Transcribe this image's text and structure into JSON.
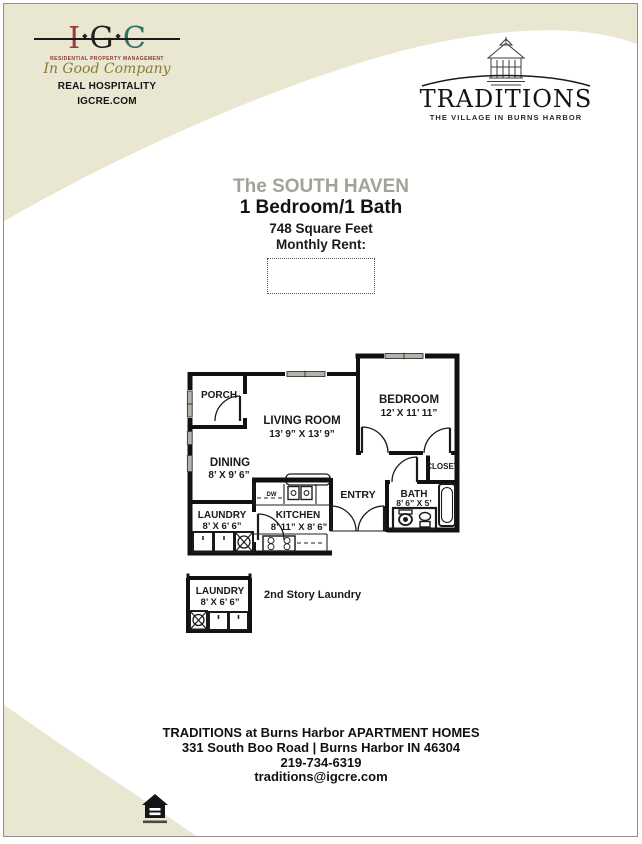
{
  "colors": {
    "beige": "#e9e6d2",
    "border_gray": "#8f8f8f",
    "title_gray": "#a2a296",
    "igc_i": "#9e3a31",
    "igc_g": "#23201d",
    "igc_c": "#2f6f66",
    "igc_script_olive": "#8d7b35",
    "igc_subtitle_maroon": "#8a3a33"
  },
  "header": {
    "igc": {
      "letters": [
        "I",
        "G",
        "C"
      ],
      "separator": "◆",
      "subtitle": "RESIDENTIAL PROPERTY MANAGEMENT",
      "script": "In Good Company",
      "line1": "REAL HOSPITALITY",
      "line2": "IGCRE.COM"
    },
    "traditions": {
      "wordmark": "TRADITIONS",
      "tagline": "THE VILLAGE IN BURNS HARBOR"
    }
  },
  "title": {
    "plan_name": "The SOUTH HAVEN",
    "config": "1 Bedroom/1 Bath",
    "sqft": "748 Square Feet",
    "rent_label": "Monthly Rent:"
  },
  "floorplan": {
    "porch": {
      "name": "PORCH"
    },
    "living": {
      "name": "LIVING ROOM",
      "dims": "13’ 9” X 13’ 9”"
    },
    "bedroom": {
      "name": "BEDROOM",
      "dims": "12’ X 11’ 11”"
    },
    "dining": {
      "name": "DINING",
      "dims": "8’ X 9’ 6”"
    },
    "laundry": {
      "name": "LAUNDRY",
      "dims": "8’ X 6’ 6”"
    },
    "kitchen": {
      "name": "KITCHEN",
      "dims": "8’ 11” X 8’ 6”"
    },
    "entry": {
      "name": "ENTRY"
    },
    "bath": {
      "name": "BATH",
      "dims": "8’ 6” X 5’"
    },
    "closet": {
      "name": "CLOSET"
    },
    "laundry2": {
      "name": "LAUNDRY",
      "dims": "8’ X 6’ 6”"
    },
    "kitchen_dw": "DW",
    "note": "2nd Story Laundry"
  },
  "footer": {
    "line1": "TRADITIONS at Burns Harbor APARTMENT HOMES",
    "line2": "331 South Boo Road | Burns Harbor IN 46304",
    "phone": "219-734-6319",
    "email": "traditions@igcre.com"
  }
}
